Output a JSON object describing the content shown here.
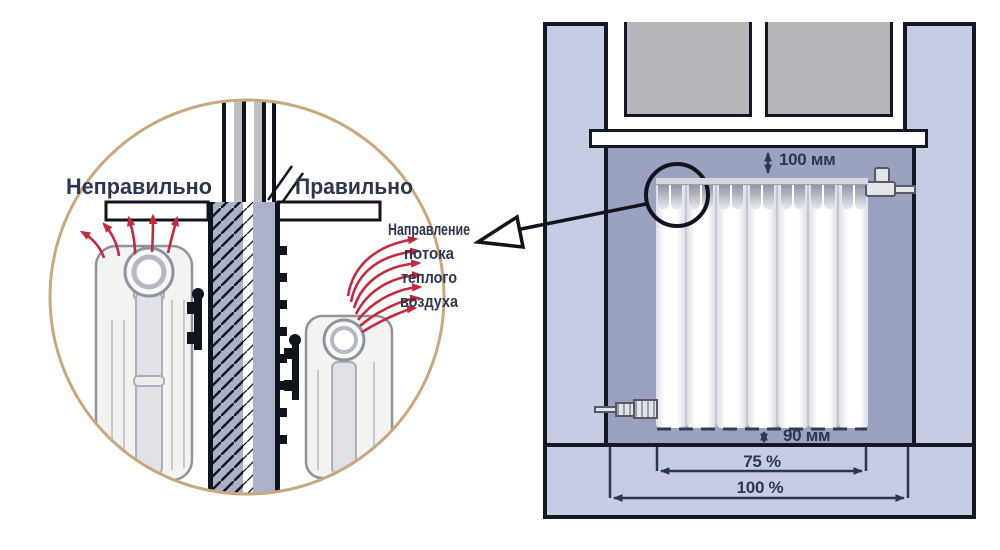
{
  "inset": {
    "incorrect_label": "Неправильно",
    "correct_label": "Правильно",
    "airflow_lines": [
      "Направление",
      "потока",
      "теплого",
      "воздуха"
    ]
  },
  "panel": {
    "gap_top": "100 мм",
    "gap_bottom": "90 мм",
    "radiator_width": "75 %",
    "niche_width": "100 %"
  },
  "icons": {
    "callout_arrow": "hollow-left-arrow",
    "airflow_arrows": "curved-red-arrow-fan",
    "dimension_arrows": "double-headed-arrow",
    "callout_circle": "magnifier-circle"
  },
  "colors": {
    "label_navy": "#2d3650",
    "accent_red": "#c5293c",
    "circle_tan": "#c9a87c",
    "wall_lavender": "#c6cce4",
    "niche_gray": "#9aa2bf",
    "outline_black": "#141824",
    "glass_gray": "#b7b5b9"
  }
}
